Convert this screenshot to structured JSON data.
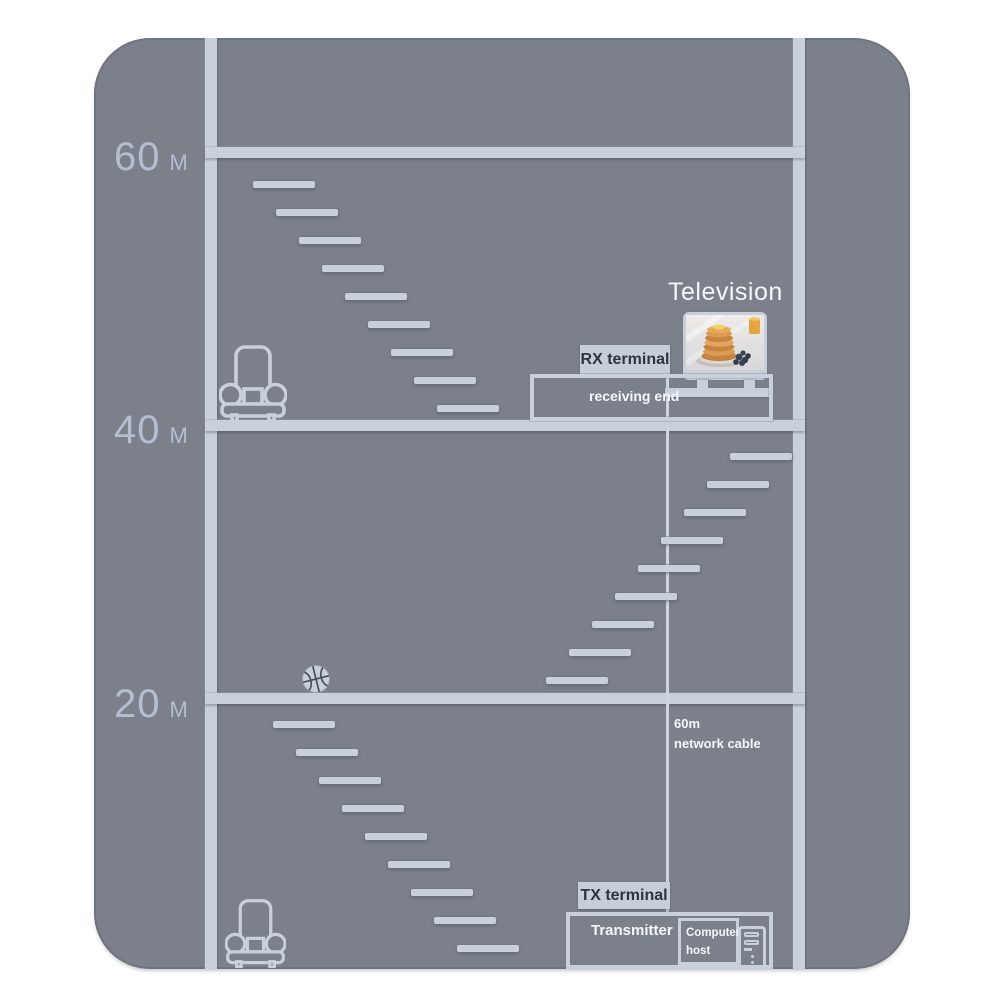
{
  "colors": {
    "page_bg": "#ffffff",
    "building": "#7b808a",
    "line_light": "#c9d0dc",
    "floor_label": "#b4bed0",
    "text_white": "#f4f6f9",
    "label_box_bg": "#c7ced9",
    "label_box_text": "#2f343e",
    "seam_dark": "#4a505c"
  },
  "floors": [
    {
      "value": "60",
      "unit": "M"
    },
    {
      "value": "40",
      "unit": "M"
    },
    {
      "value": "20",
      "unit": "M"
    }
  ],
  "television": {
    "title": "Television"
  },
  "receiver": {
    "label": "RX terminal",
    "caption": "receiving end"
  },
  "transmitter": {
    "label": "TX terminal",
    "caption": "Transmitter"
  },
  "cable": {
    "line1": "60m",
    "line2": "network cable"
  },
  "computer_host": {
    "line1": "Computer",
    "line2": "host"
  },
  "staircases": [
    {
      "id": "upper-staircase",
      "x": 159,
      "y": 143,
      "dx": 23,
      "dy": 28,
      "count": 9,
      "w": 62,
      "h": 7
    },
    {
      "id": "middle-staircase",
      "x": 636,
      "y": 415,
      "dx": -23,
      "dy": 28,
      "count": 9,
      "w": 62,
      "h": 7
    },
    {
      "id": "lower-staircase",
      "x": 179,
      "y": 683,
      "dx": 23,
      "dy": 28,
      "count": 9,
      "w": 62,
      "h": 7
    }
  ],
  "icons": [
    "armchair-icon",
    "basketball-icon",
    "television-icon",
    "computer-tower-icon"
  ]
}
